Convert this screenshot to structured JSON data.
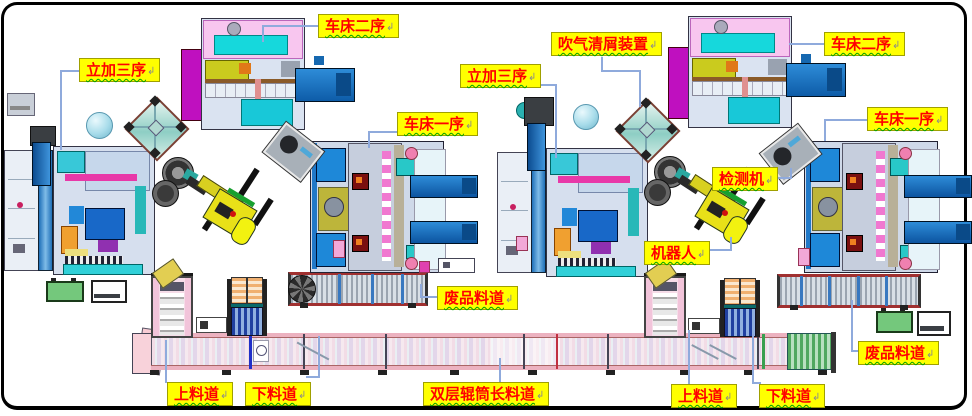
{
  "labels": [
    {
      "text": "立加三序"
    },
    {
      "text": "车床二序"
    },
    {
      "text": "吹气清屑装置"
    },
    {
      "text": "立加三序"
    },
    {
      "text": "车床一序"
    },
    {
      "text": "车床二序"
    },
    {
      "text": "车床一序"
    },
    {
      "text": "检测机"
    },
    {
      "text": "机器人"
    },
    {
      "text": "废品料道"
    },
    {
      "text": "废品料道"
    },
    {
      "text": "上料道"
    },
    {
      "text": "下料道"
    },
    {
      "text": "双层辊筒长料道"
    },
    {
      "text": "上料道"
    },
    {
      "text": "下料道"
    }
  ],
  "marks": {
    "return": "↲"
  },
  "colors": {
    "label_bg": "#FFFF00",
    "label_text": "#FF0000",
    "leader_line": "#8FAADC",
    "machine_pink": "#F8C6EF",
    "machine_cyan": "#16D8DC",
    "machine_magenta": "#BF10BF",
    "conveyor_blue": "#1474C8",
    "robot_yellow": "#E8E018",
    "belt_pink": "#F2DCE6",
    "scrap_gray": "#9AA4B0",
    "box_green": "#74C87C"
  }
}
